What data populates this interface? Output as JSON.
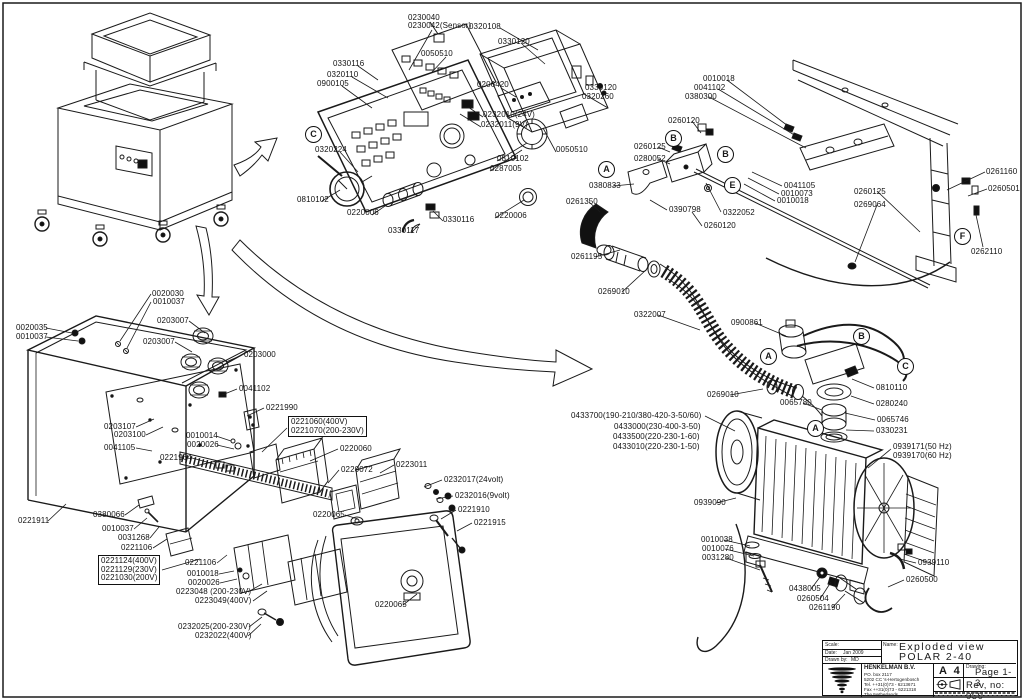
{
  "colors": {
    "ink": "#1a1a1a",
    "paper": "#ffffff"
  },
  "title_block": {
    "scale_label": "Scale:",
    "scale_value": "",
    "date_label": "Date:",
    "date_value": "Jan 2009",
    "drawn_label": "Drawn by:",
    "drawn_value": "MD",
    "name_label": "Name:",
    "name_line1": "Exploded view",
    "name_line2": "POLAR 2-40",
    "company": {
      "name": "HENKELMAN B.V.",
      "address1": "PO. box 2117",
      "address2": "5202 CC  's-Hertogenbosch",
      "tel": "Tel.  ++31(0)73 - 6213671",
      "fax": "Fax  ++31(0)73 - 6221318",
      "country": "The Netherlands"
    },
    "paper": "A 4",
    "drawing_label": "Drawing:",
    "page_no": "Page 1-3",
    "rev": "Rev, no: 050"
  },
  "part_labels": [
    {
      "t": "0230040",
      "x": 408,
      "y": 14
    },
    {
      "t": "0230042(Sensor)",
      "x": 408,
      "y": 22
    },
    {
      "t": "0320108",
      "x": 469,
      "y": 23
    },
    {
      "t": "0330120",
      "x": 498,
      "y": 38
    },
    {
      "t": "0050510",
      "x": 421,
      "y": 50
    },
    {
      "t": "0330116",
      "x": 333,
      "y": 60
    },
    {
      "t": "0320110",
      "x": 327,
      "y": 71
    },
    {
      "t": "0900105",
      "x": 317,
      "y": 80
    },
    {
      "t": "0206420",
      "x": 477,
      "y": 81
    },
    {
      "t": "0330120",
      "x": 585,
      "y": 84
    },
    {
      "t": "0320260",
      "x": 582,
      "y": 93
    },
    {
      "t": "0232010(24V)",
      "x": 483,
      "y": 111
    },
    {
      "t": "0232011(9V)",
      "x": 481,
      "y": 121
    },
    {
      "t": "0320224",
      "x": 315,
      "y": 146
    },
    {
      "t": "0050510",
      "x": 556,
      "y": 146
    },
    {
      "t": "0810102",
      "x": 497,
      "y": 155
    },
    {
      "t": "0287005",
      "x": 490,
      "y": 165
    },
    {
      "t": "0810102",
      "x": 297,
      "y": 196
    },
    {
      "t": "0220006",
      "x": 347,
      "y": 209
    },
    {
      "t": "0220006",
      "x": 495,
      "y": 212
    },
    {
      "t": "0330116",
      "x": 443,
      "y": 216
    },
    {
      "t": "0330117",
      "x": 388,
      "y": 227
    },
    {
      "t": "0010018",
      "x": 703,
      "y": 75
    },
    {
      "t": "0041102",
      "x": 694,
      "y": 84
    },
    {
      "t": "0380300",
      "x": 685,
      "y": 93
    },
    {
      "t": "0260120",
      "x": 668,
      "y": 117
    },
    {
      "t": "0260125",
      "x": 634,
      "y": 143
    },
    {
      "t": "0280052",
      "x": 634,
      "y": 155
    },
    {
      "t": "0380833",
      "x": 589,
      "y": 182
    },
    {
      "t": "0041105",
      "x": 784,
      "y": 182
    },
    {
      "t": "0010073",
      "x": 781,
      "y": 190
    },
    {
      "t": "0010018",
      "x": 777,
      "y": 197
    },
    {
      "t": "0390798",
      "x": 669,
      "y": 206
    },
    {
      "t": "0322052",
      "x": 723,
      "y": 209
    },
    {
      "t": "0260120",
      "x": 704,
      "y": 222
    },
    {
      "t": "0261350",
      "x": 566,
      "y": 198
    },
    {
      "t": "0261195",
      "x": 571,
      "y": 253
    },
    {
      "t": "0269010",
      "x": 598,
      "y": 288
    },
    {
      "t": "0322007",
      "x": 634,
      "y": 311
    },
    {
      "t": "0900861",
      "x": 731,
      "y": 319
    },
    {
      "t": "0260125",
      "x": 854,
      "y": 188
    },
    {
      "t": "0269064",
      "x": 854,
      "y": 201
    },
    {
      "t": "0261160",
      "x": 986,
      "y": 168
    },
    {
      "t": "0260501",
      "x": 988,
      "y": 185
    },
    {
      "t": "0262110",
      "x": 971,
      "y": 248
    },
    {
      "t": "0269010",
      "x": 707,
      "y": 391
    },
    {
      "t": "0065780",
      "x": 780,
      "y": 399
    },
    {
      "t": "0433700(190-210/380-420-3-50/60)",
      "x": 571,
      "y": 412
    },
    {
      "t": "0433000(230-400-3-50)",
      "x": 614,
      "y": 423
    },
    {
      "t": "0433500(220-230-1-60)",
      "x": 613,
      "y": 433
    },
    {
      "t": "0433010(220-230-1-50)",
      "x": 613,
      "y": 443
    },
    {
      "t": "0810110",
      "x": 876,
      "y": 384
    },
    {
      "t": "0280240",
      "x": 876,
      "y": 400
    },
    {
      "t": "0065746",
      "x": 877,
      "y": 416
    },
    {
      "t": "0330231",
      "x": 876,
      "y": 427
    },
    {
      "t": "0939171(50 Hz)",
      "x": 893,
      "y": 443
    },
    {
      "t": "0939170(60 Hz)",
      "x": 893,
      "y": 452
    },
    {
      "t": "0939090",
      "x": 694,
      "y": 499
    },
    {
      "t": "0010038",
      "x": 701,
      "y": 536
    },
    {
      "t": "0010076",
      "x": 702,
      "y": 545
    },
    {
      "t": "0031280",
      "x": 702,
      "y": 554
    },
    {
      "t": "0438005",
      "x": 789,
      "y": 585
    },
    {
      "t": "0260504",
      "x": 797,
      "y": 595
    },
    {
      "t": "0261190",
      "x": 809,
      "y": 604
    },
    {
      "t": "0939110",
      "x": 918,
      "y": 559
    },
    {
      "t": "0260500",
      "x": 906,
      "y": 576
    },
    {
      "t": "0020030",
      "x": 152,
      "y": 290
    },
    {
      "t": "0010037",
      "x": 153,
      "y": 298
    },
    {
      "t": "0020035",
      "x": 16,
      "y": 324
    },
    {
      "t": "0010037",
      "x": 16,
      "y": 333
    },
    {
      "t": "0203007",
      "x": 157,
      "y": 317
    },
    {
      "t": "0203007",
      "x": 143,
      "y": 338
    },
    {
      "t": "0203000",
      "x": 244,
      "y": 351
    },
    {
      "t": "0041102",
      "x": 239,
      "y": 385
    },
    {
      "t": "0221990",
      "x": 266,
      "y": 404
    },
    {
      "t": "0203107",
      "x": 104,
      "y": 423
    },
    {
      "t": "0203100",
      "x": 114,
      "y": 431
    },
    {
      "t": "0041105",
      "x": 104,
      "y": 444
    },
    {
      "t": "0010014",
      "x": 186,
      "y": 432
    },
    {
      "t": "0020026",
      "x": 187,
      "y": 441
    },
    {
      "t": "0221964",
      "x": 160,
      "y": 454
    },
    {
      "t": "0221911",
      "x": 18,
      "y": 517
    },
    {
      "t": "0380066",
      "x": 93,
      "y": 511
    },
    {
      "t": "0010037",
      "x": 102,
      "y": 525
    },
    {
      "t": "0031268",
      "x": 118,
      "y": 534
    },
    {
      "t": "0221106",
      "x": 121,
      "y": 544
    },
    {
      "t": "0221106",
      "x": 185,
      "y": 559
    },
    {
      "t": "0010018",
      "x": 187,
      "y": 570
    },
    {
      "t": "0020026",
      "x": 188,
      "y": 579
    },
    {
      "t": "0223048 (200-230V)",
      "x": 176,
      "y": 588
    },
    {
      "t": "0223049(400V)",
      "x": 195,
      "y": 597
    },
    {
      "t": "0232025(200-230V)",
      "x": 178,
      "y": 623
    },
    {
      "t": "0232022(400V)",
      "x": 195,
      "y": 632
    },
    {
      "t": "0220060",
      "x": 340,
      "y": 445
    },
    {
      "t": "0220072",
      "x": 341,
      "y": 466
    },
    {
      "t": "0223011",
      "x": 396,
      "y": 461
    },
    {
      "t": "0232017(24volt)",
      "x": 444,
      "y": 476
    },
    {
      "t": "0232016(9volt)",
      "x": 455,
      "y": 492
    },
    {
      "t": "0220065",
      "x": 313,
      "y": 511
    },
    {
      "t": "0221910",
      "x": 458,
      "y": 506
    },
    {
      "t": "0221915",
      "x": 474,
      "y": 519
    },
    {
      "t": "0220065",
      "x": 375,
      "y": 601
    }
  ],
  "boxed_labels": [
    {
      "lines": [
        "0221060(400V)",
        "0221070(200-230V)"
      ],
      "x": 288,
      "y": 416
    },
    {
      "lines": [
        "0221124(400V)",
        "0221129(230V)",
        "0221030(200V)"
      ],
      "x": 98,
      "y": 555
    }
  ],
  "view_markers": [
    {
      "letter": "C",
      "x": 305,
      "y": 126
    },
    {
      "letter": "B",
      "x": 665,
      "y": 130
    },
    {
      "letter": "B",
      "x": 717,
      "y": 146
    },
    {
      "letter": "A",
      "x": 598,
      "y": 161
    },
    {
      "letter": "E",
      "x": 724,
      "y": 177
    },
    {
      "letter": "F",
      "x": 954,
      "y": 228
    },
    {
      "letter": "A",
      "x": 760,
      "y": 348
    },
    {
      "letter": "B",
      "x": 853,
      "y": 328
    },
    {
      "letter": "C",
      "x": 897,
      "y": 358
    },
    {
      "letter": "A",
      "x": 807,
      "y": 420
    }
  ]
}
